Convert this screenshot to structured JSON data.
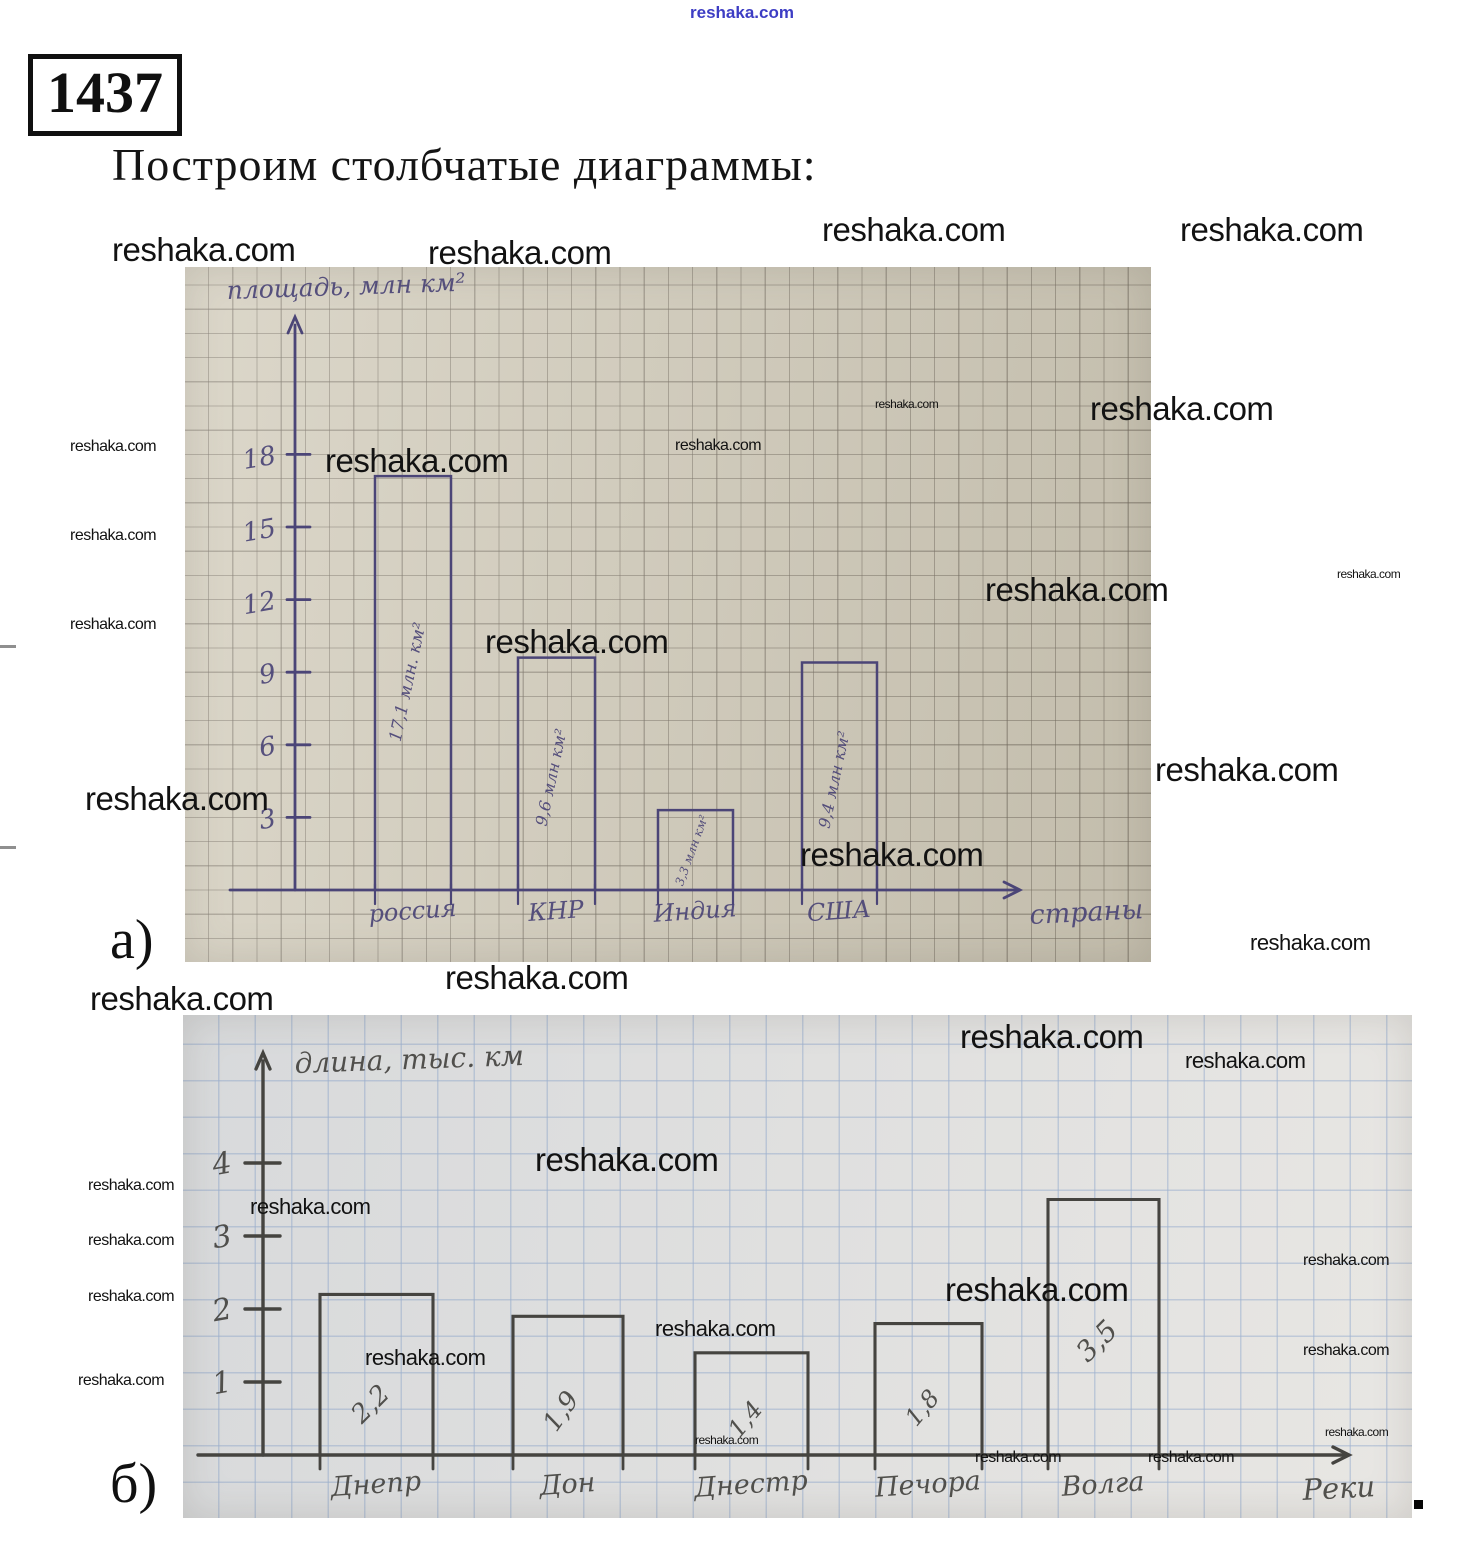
{
  "header": {
    "problem_number": "1437",
    "title": "Построим столбчатые диаграммы:"
  },
  "section_labels": {
    "a": "а)",
    "b": "б)"
  },
  "end_period": ".",
  "watermark_text": "reshaka.com",
  "colors": {
    "ink_chart_a": "#4b4577",
    "ink_chart_b": "#454440",
    "paper_chart_a": "#d2ccbb",
    "paper_chart_b": "#e3e1dd",
    "watermark": "#121212",
    "watermark_blue": "#3d3dc4"
  },
  "chart_data": [
    {
      "type": "bar",
      "title": "",
      "ylabel": "площадь, млн км²",
      "xlabel": "страны",
      "categories": [
        "россия",
        "КНР",
        "Индия",
        "США"
      ],
      "values": [
        17.1,
        9.6,
        3.3,
        9.4
      ],
      "bar_labels": [
        "17,1 млн. км²",
        "9,6 млн км²",
        "3,3 млн км²",
        "9,4 млн км²"
      ],
      "yticks": [
        3,
        6,
        9,
        12,
        15,
        18
      ],
      "ylim": [
        0,
        21
      ],
      "grid": "graph-paper",
      "legend": "none"
    },
    {
      "type": "bar",
      "title": "",
      "ylabel": "длина, тыс. км",
      "xlabel": "Реки",
      "categories": [
        "Днепр",
        "Дон",
        "Днестр",
        "Печора",
        "Волга"
      ],
      "values": [
        2.2,
        1.9,
        1.4,
        1.8,
        3.5
      ],
      "bar_labels": [
        "2,2",
        "1,9",
        "1,4",
        "1,8",
        "3,5"
      ],
      "yticks": [
        1,
        2,
        3,
        4
      ],
      "ylim": [
        0,
        5
      ],
      "grid": "graph-paper",
      "legend": "none"
    }
  ]
}
